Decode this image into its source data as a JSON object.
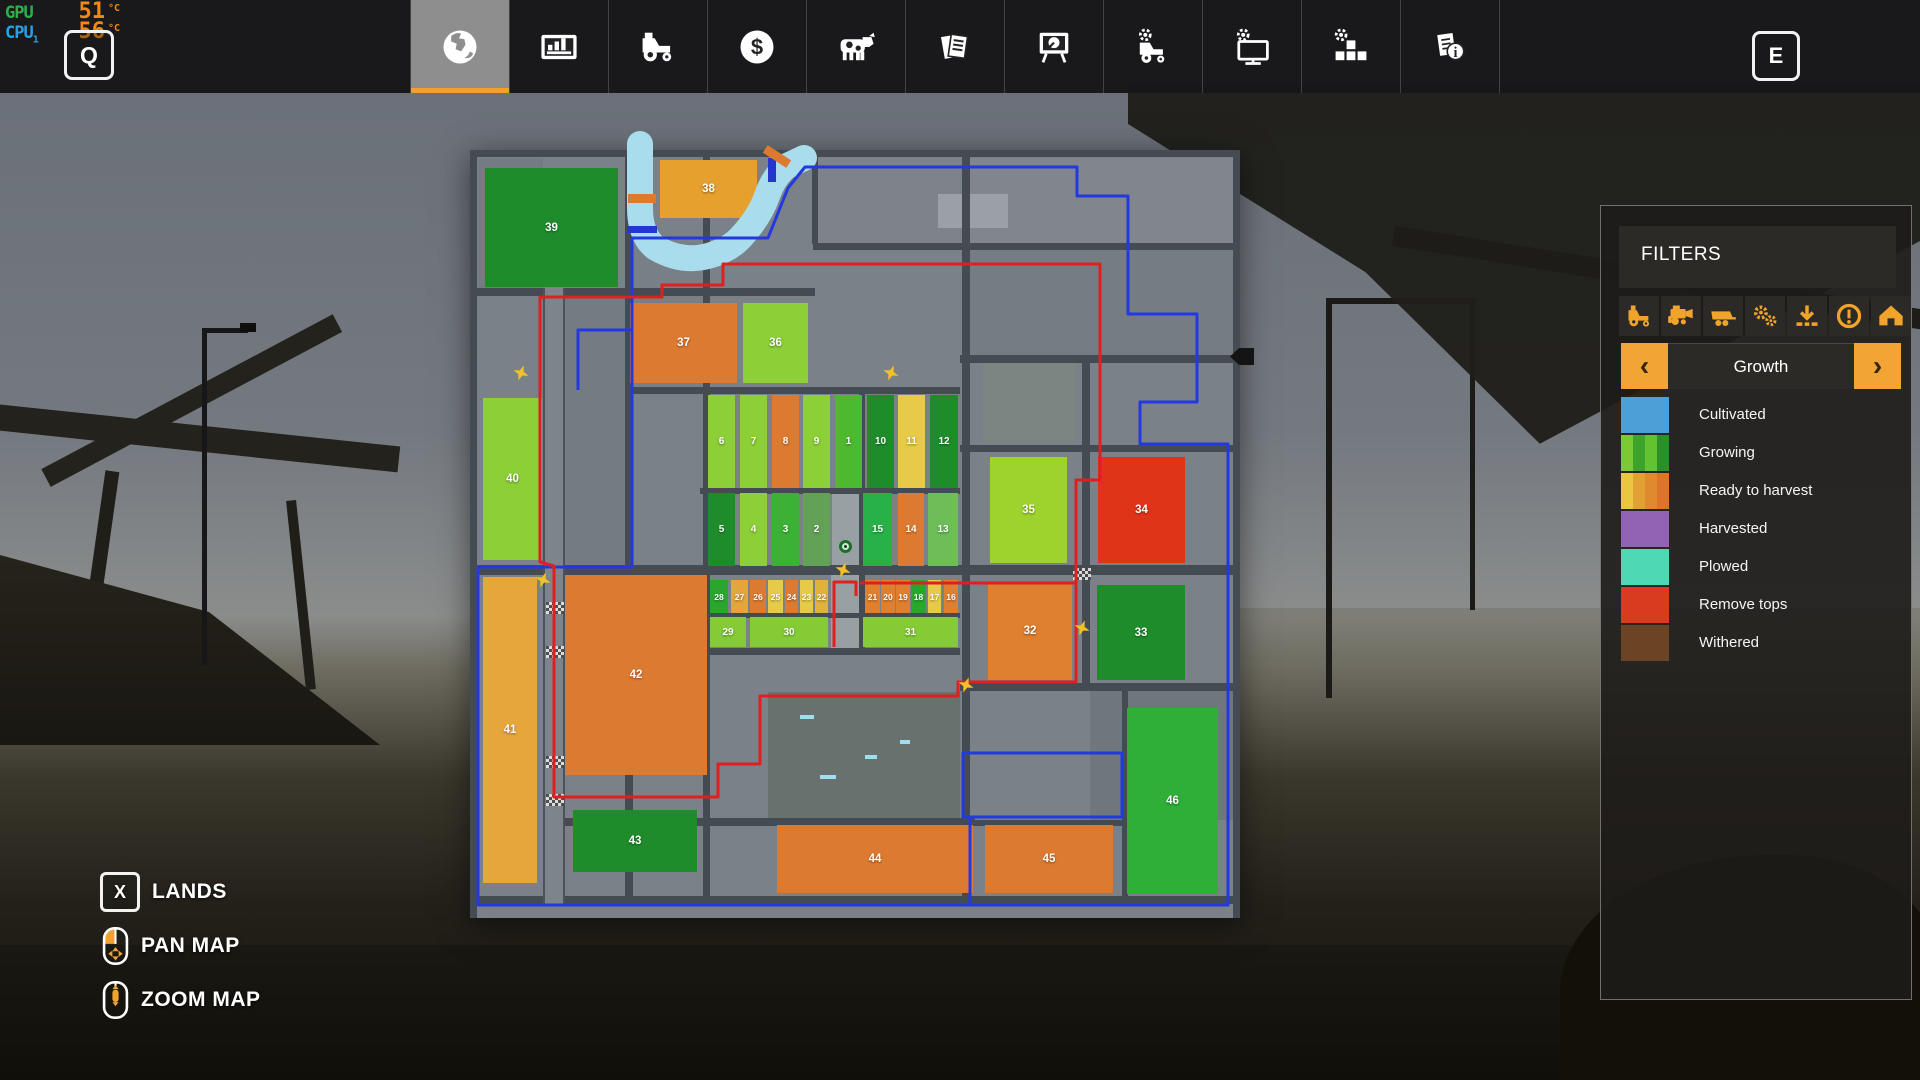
{
  "monitor": {
    "gpu_label": "GPU",
    "gpu_temp": "51",
    "cpu_label": "CPU",
    "cpu_index": "1",
    "cpu_temp": "56",
    "temp_unit": "°C"
  },
  "hotkeys": {
    "map_key_left": "Q",
    "map_key_right": "E"
  },
  "topbar": {
    "tabs": [
      {
        "name": "map",
        "icon": "globe-icon",
        "active": true
      },
      {
        "name": "statistics",
        "icon": "stats-icon",
        "active": false
      },
      {
        "name": "vehicles",
        "icon": "tractor-icon",
        "active": false
      },
      {
        "name": "finances",
        "icon": "finances-icon",
        "active": false
      },
      {
        "name": "animals",
        "icon": "animals-icon",
        "active": false
      },
      {
        "name": "contracts",
        "icon": "contracts-icon",
        "active": false
      },
      {
        "name": "production",
        "icon": "production-icon",
        "active": false
      },
      {
        "name": "garage",
        "icon": "garage-icon",
        "active": false
      },
      {
        "name": "system",
        "icon": "pc-icon",
        "active": false
      },
      {
        "name": "modules",
        "icon": "blocks-icon",
        "active": false
      },
      {
        "name": "help",
        "icon": "help-icon",
        "active": false
      }
    ]
  },
  "filters": {
    "title": "FILTERS",
    "buttons": [
      {
        "name": "tractors",
        "icon": "filter-tractor-icon"
      },
      {
        "name": "harvesters",
        "icon": "filter-harvester-icon"
      },
      {
        "name": "trailers",
        "icon": "filter-trailer-icon"
      },
      {
        "name": "implements",
        "icon": "filter-gears-icon"
      },
      {
        "name": "loading",
        "icon": "filter-download-icon"
      },
      {
        "name": "warnings",
        "icon": "filter-warning-icon"
      },
      {
        "name": "buildings",
        "icon": "filter-house-icon"
      }
    ]
  },
  "growth": {
    "label": "Growth",
    "prev_symbol": "‹",
    "next_symbol": "›",
    "legend": [
      {
        "label": "Cultivated",
        "colors": [
          "#4c9fd7"
        ]
      },
      {
        "label": "Growing",
        "colors": [
          "#7cc933",
          "#3da32d",
          "#63c230",
          "#2d8f2a"
        ]
      },
      {
        "label": "Ready to harvest",
        "colors": [
          "#e9c83f",
          "#e3a135",
          "#df8a2f",
          "#dd742c"
        ]
      },
      {
        "label": "Harvested",
        "colors": [
          "#9263b5"
        ]
      },
      {
        "label": "Plowed",
        "colors": [
          "#4fd9b2"
        ]
      },
      {
        "label": "Remove tops",
        "colors": [
          "#d93b1e"
        ]
      },
      {
        "label": "Withered",
        "colors": [
          "#6b4423"
        ]
      }
    ]
  },
  "footer": {
    "lands_key": "X",
    "lands_label": "LANDS",
    "pan_label": "PAN MAP",
    "zoom_label": "ZOOM MAP"
  },
  "map": {
    "bg": "#7a8189",
    "road_color": "#454b53",
    "river_color": "#a9ddee",
    "river_path": "M170 -6 L170 58 Q170 86 186 98 Q212 113 238 106 Q260 100 272 86 Q290 66 297 46 Q304 26 317 16 L334 8",
    "parcels": [
      {
        "x": 500,
        "y": 8,
        "w": 263,
        "h": 85,
        "c": "#81868e"
      },
      {
        "x": 500,
        "y": 100,
        "w": 263,
        "h": 105,
        "c": "#767c84"
      },
      {
        "x": 345,
        "y": 8,
        "w": 145,
        "h": 85,
        "c": "#7e838b"
      },
      {
        "x": 513,
        "y": 213,
        "w": 92,
        "h": 80,
        "c": "#7d8583"
      },
      {
        "x": 298,
        "y": 542,
        "w": 192,
        "h": 126,
        "c": "#68716d"
      },
      {
        "x": 8,
        "y": 8,
        "w": 65,
        "h": 130,
        "c": "#757b83"
      },
      {
        "x": 95,
        "y": 138,
        "w": 60,
        "h": 277,
        "c": "#747b83"
      },
      {
        "x": 620,
        "y": 540,
        "w": 143,
        "h": 130,
        "c": "#70767e"
      },
      {
        "x": 163,
        "y": 93,
        "w": 70,
        "h": 145,
        "c": "#787f87"
      },
      {
        "x": 362,
        "y": 343,
        "w": 30,
        "h": 74,
        "c": "#99a0a4"
      },
      {
        "x": 361,
        "y": 425,
        "w": 30,
        "h": 73,
        "c": "#99a0a4"
      },
      {
        "x": 468,
        "y": 44,
        "w": 70,
        "h": 34,
        "c": "#9aa0a6"
      }
    ],
    "decor": [
      {
        "x": 330,
        "y": 565,
        "w": 14,
        "h": 4,
        "c": "#9fdef0"
      },
      {
        "x": 395,
        "y": 605,
        "w": 12,
        "h": 4,
        "c": "#9fdef0"
      },
      {
        "x": 350,
        "y": 625,
        "w": 16,
        "h": 4,
        "c": "#9fdef0"
      },
      {
        "x": 430,
        "y": 590,
        "w": 10,
        "h": 4,
        "c": "#9fdef0"
      }
    ],
    "roads": [
      {
        "x": 0,
        "y": 0,
        "w": 770,
        "h": 7
      },
      {
        "x": 343,
        "y": 93,
        "w": 427,
        "h": 7
      },
      {
        "x": 0,
        "y": 138,
        "w": 345,
        "h": 8
      },
      {
        "x": 490,
        "y": 205,
        "w": 280,
        "h": 8
      },
      {
        "x": 155,
        "y": 237,
        "w": 335,
        "h": 7
      },
      {
        "x": 490,
        "y": 295,
        "w": 280,
        "h": 7
      },
      {
        "x": 230,
        "y": 338,
        "w": 260,
        "h": 6
      },
      {
        "x": 0,
        "y": 415,
        "w": 770,
        "h": 10
      },
      {
        "x": 230,
        "y": 463,
        "w": 260,
        "h": 5
      },
      {
        "x": 230,
        "y": 498,
        "w": 260,
        "h": 7
      },
      {
        "x": 490,
        "y": 533,
        "w": 280,
        "h": 8
      },
      {
        "x": 75,
        "y": 668,
        "w": 430,
        "h": 8
      },
      {
        "x": 505,
        "y": 670,
        "w": 152,
        "h": 6
      },
      {
        "x": 0,
        "y": 746,
        "w": 770,
        "h": 8
      },
      {
        "x": 0,
        "y": 0,
        "w": 7,
        "h": 768
      },
      {
        "x": 73,
        "y": 138,
        "w": 22,
        "h": 616,
        "light": true
      },
      {
        "x": 155,
        "y": 0,
        "w": 8,
        "h": 746
      },
      {
        "x": 233,
        "y": 0,
        "w": 7,
        "h": 746
      },
      {
        "x": 342,
        "y": 0,
        "w": 6,
        "h": 94
      },
      {
        "x": 389,
        "y": 237,
        "w": 6,
        "h": 266
      },
      {
        "x": 492,
        "y": 0,
        "w": 8,
        "h": 746
      },
      {
        "x": 612,
        "y": 205,
        "w": 8,
        "h": 336
      },
      {
        "x": 652,
        "y": 533,
        "w": 6,
        "h": 214
      },
      {
        "x": 763,
        "y": 0,
        "w": 7,
        "h": 768
      }
    ],
    "crossings": [
      {
        "x": 76,
        "y": 452
      },
      {
        "x": 76,
        "y": 496
      },
      {
        "x": 76,
        "y": 606
      },
      {
        "x": 76,
        "y": 644
      },
      {
        "x": 603,
        "y": 418
      }
    ],
    "fields": [
      {
        "n": 39,
        "x": 15,
        "y": 18,
        "w": 133,
        "h": 119,
        "c": "#1f8c2b"
      },
      {
        "n": 38,
        "x": 190,
        "y": 10,
        "w": 97,
        "h": 58,
        "c": "#e5a02e"
      },
      {
        "n": 37,
        "x": 160,
        "y": 153,
        "w": 107,
        "h": 80,
        "c": "#dd7a31"
      },
      {
        "n": 36,
        "x": 273,
        "y": 153,
        "w": 65,
        "h": 80,
        "c": "#8ccf36"
      },
      {
        "n": 40,
        "x": 13,
        "y": 248,
        "w": 59,
        "h": 162,
        "c": "#8ccf36"
      },
      {
        "n": 41,
        "x": 13,
        "y": 427,
        "w": 54,
        "h": 306,
        "c": "#e7a63c"
      },
      {
        "n": 42,
        "x": 95,
        "y": 425,
        "w": 142,
        "h": 200,
        "c": "#dd7a31"
      },
      {
        "n": 43,
        "x": 103,
        "y": 660,
        "w": 124,
        "h": 62,
        "c": "#1f8c2b"
      },
      {
        "n": 44,
        "x": 307,
        "y": 675,
        "w": 196,
        "h": 68,
        "c": "#dd7a31"
      },
      {
        "n": 45,
        "x": 515,
        "y": 675,
        "w": 128,
        "h": 68,
        "c": "#dd7a31"
      },
      {
        "n": 46,
        "x": 657,
        "y": 558,
        "w": 91,
        "h": 186,
        "c": "#2fae38"
      },
      {
        "n": 35,
        "x": 520,
        "y": 307,
        "w": 77,
        "h": 106,
        "c": "#9ed32e"
      },
      {
        "n": 34,
        "x": 628,
        "y": 307,
        "w": 87,
        "h": 106,
        "c": "#df3418"
      },
      {
        "n": 32,
        "x": 518,
        "y": 432,
        "w": 84,
        "h": 98,
        "c": "#df7f30"
      },
      {
        "n": 33,
        "x": 627,
        "y": 435,
        "w": 88,
        "h": 95,
        "c": "#1f8c2b"
      },
      {
        "n": 6,
        "x": 238,
        "y": 245,
        "w": 27,
        "h": 93,
        "c": "#8ccf36",
        "fs": 10
      },
      {
        "n": 7,
        "x": 270,
        "y": 245,
        "w": 27,
        "h": 93,
        "c": "#8ccf36",
        "fs": 10
      },
      {
        "n": 8,
        "x": 302,
        "y": 245,
        "w": 27,
        "h": 93,
        "c": "#dd7a31",
        "fs": 10
      },
      {
        "n": 9,
        "x": 333,
        "y": 245,
        "w": 27,
        "h": 93,
        "c": "#8ccf36",
        "fs": 10
      },
      {
        "n": 1,
        "x": 365,
        "y": 245,
        "w": 27,
        "h": 93,
        "c": "#4db92e",
        "fs": 10
      },
      {
        "n": 10,
        "x": 397,
        "y": 245,
        "w": 27,
        "h": 93,
        "c": "#1f8c2b",
        "fs": 10
      },
      {
        "n": 11,
        "x": 428,
        "y": 245,
        "w": 27,
        "h": 93,
        "c": "#e8ca4a",
        "fs": 10
      },
      {
        "n": 12,
        "x": 460,
        "y": 245,
        "w": 28,
        "h": 93,
        "c": "#1f8c2b",
        "fs": 10
      },
      {
        "n": 5,
        "x": 238,
        "y": 343,
        "w": 27,
        "h": 73,
        "c": "#1f8c2b",
        "fs": 10
      },
      {
        "n": 4,
        "x": 270,
        "y": 343,
        "w": 27,
        "h": 73,
        "c": "#8ccf36",
        "fs": 10
      },
      {
        "n": 3,
        "x": 302,
        "y": 343,
        "w": 27,
        "h": 73,
        "c": "#3cb135",
        "fs": 10
      },
      {
        "n": 2,
        "x": 333,
        "y": 343,
        "w": 27,
        "h": 73,
        "c": "#63a156",
        "fs": 10
      },
      {
        "n": 15,
        "x": 393,
        "y": 343,
        "w": 29,
        "h": 73,
        "c": "#28b148",
        "fs": 10
      },
      {
        "n": 14,
        "x": 428,
        "y": 343,
        "w": 26,
        "h": 73,
        "c": "#dd7a31",
        "fs": 10
      },
      {
        "n": 13,
        "x": 458,
        "y": 343,
        "w": 30,
        "h": 73,
        "c": "#6dbd58",
        "fs": 10
      },
      {
        "n": 28,
        "x": 240,
        "y": 430,
        "w": 18,
        "h": 33,
        "c": "#2aa62e",
        "fs": 8.5
      },
      {
        "n": 27,
        "x": 261,
        "y": 430,
        "w": 17,
        "h": 33,
        "c": "#e5a43c",
        "fs": 8.5
      },
      {
        "n": 26,
        "x": 280,
        "y": 430,
        "w": 16,
        "h": 33,
        "c": "#dd7a31",
        "fs": 8.5
      },
      {
        "n": 25,
        "x": 298,
        "y": 430,
        "w": 15,
        "h": 33,
        "c": "#e8ca4a",
        "fs": 8.5
      },
      {
        "n": 24,
        "x": 315,
        "y": 430,
        "w": 13,
        "h": 33,
        "c": "#dd7a31",
        "fs": 8.5
      },
      {
        "n": 23,
        "x": 330,
        "y": 430,
        "w": 13,
        "h": 33,
        "c": "#e8ca4a",
        "fs": 8.5
      },
      {
        "n": 22,
        "x": 345,
        "y": 430,
        "w": 13,
        "h": 33,
        "c": "#e0b23c",
        "fs": 8.5
      },
      {
        "n": 21,
        "x": 395,
        "y": 430,
        "w": 15,
        "h": 33,
        "c": "#df7f30",
        "fs": 8.5
      },
      {
        "n": 20,
        "x": 411,
        "y": 430,
        "w": 14,
        "h": 33,
        "c": "#df7f30",
        "fs": 8.5
      },
      {
        "n": 19,
        "x": 426,
        "y": 430,
        "w": 14,
        "h": 33,
        "c": "#df7f30",
        "fs": 8.5
      },
      {
        "n": 18,
        "x": 441,
        "y": 430,
        "w": 15,
        "h": 33,
        "c": "#2aa62e",
        "fs": 8.5
      },
      {
        "n": 17,
        "x": 458,
        "y": 430,
        "w": 13,
        "h": 33,
        "c": "#e8ca4a",
        "fs": 8.5
      },
      {
        "n": 16,
        "x": 474,
        "y": 430,
        "w": 14,
        "h": 33,
        "c": "#df7f30",
        "fs": 8.5
      },
      {
        "n": 29,
        "x": 240,
        "y": 467,
        "w": 36,
        "h": 30,
        "c": "#84cb36",
        "fs": 10
      },
      {
        "n": 30,
        "x": 280,
        "y": 467,
        "w": 78,
        "h": 30,
        "c": "#84cb36",
        "fs": 10
      },
      {
        "n": 31,
        "x": 393,
        "y": 467,
        "w": 95,
        "h": 30,
        "c": "#84cb36",
        "fs": 10
      }
    ],
    "routes": {
      "blue_color": "#2438e0",
      "red_color": "#e01f1f",
      "blue_main": "8,417 162,417 162,88 298,88 318,38 335,17 607,17 607,46 658,46 658,164 727,164 727,252 670,252 670,294 758,294 758,755 8,755 8,417",
      "blue_spur": "162,180 108,180 108,240",
      "blue_loop": "500,753 500,667 493,667 493,603 652,603 652,667 500,667",
      "red_main": "390,433 606,433 606,330 630,330 630,114 253,114 253,135 192,135 192,147 70,147 70,412 84,416 84,647 248,647 248,614 290,614 290,546 488,546 488,532 606,532 606,433",
      "red_spur": "364,497 364,432 386,432 386,446"
    },
    "bridges": [
      {
        "x": 158,
        "y": 44,
        "w": 28,
        "h": 9,
        "r": 0
      },
      {
        "x": 293,
        "y": 2,
        "w": 28,
        "h": 9,
        "r": 33
      }
    ],
    "dams": [
      {
        "x": 157,
        "y": 76,
        "w": 30,
        "h": 7
      },
      {
        "x": 298,
        "y": 8,
        "w": 8,
        "h": 24
      }
    ],
    "markers": [
      [
        51,
        223
      ],
      [
        421,
        223
      ],
      [
        73,
        430
      ],
      [
        373,
        420
      ],
      [
        496,
        535
      ],
      [
        612,
        478
      ]
    ],
    "player": {
      "x": 369,
      "y": 390
    },
    "edge_arrow": {
      "x": 760,
      "y": 198
    }
  }
}
